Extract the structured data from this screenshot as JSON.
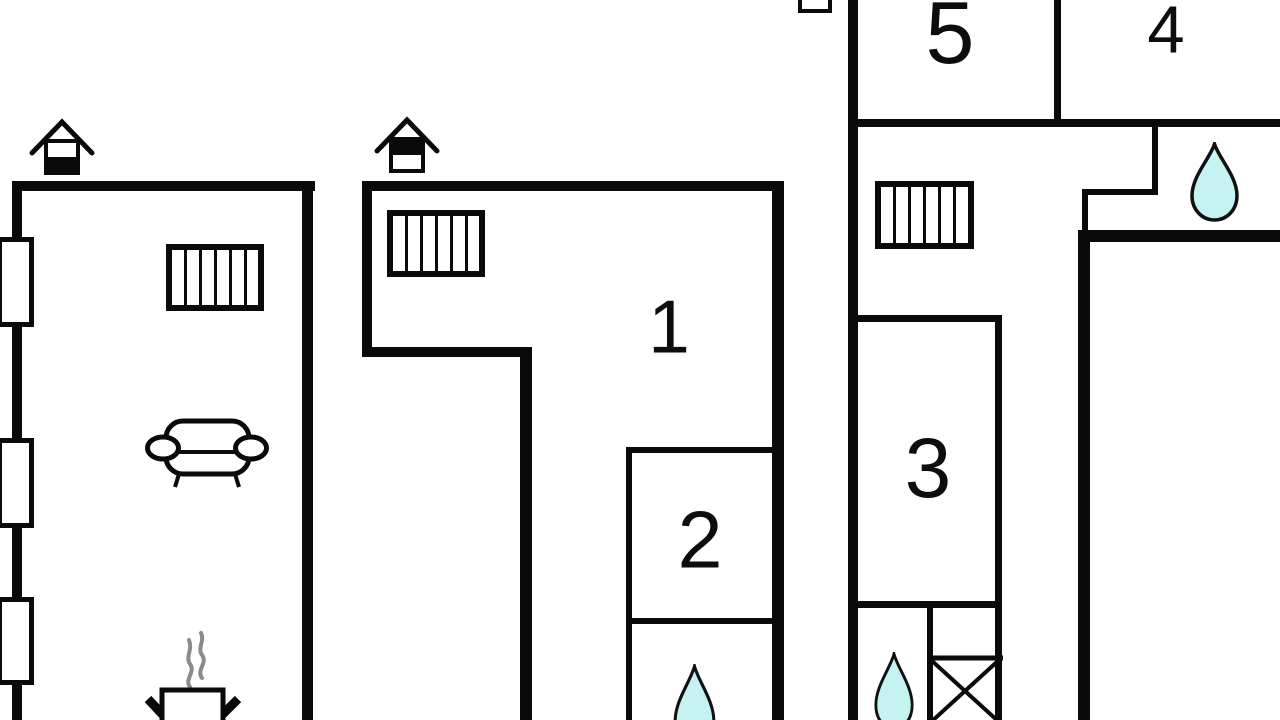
{
  "plan": {
    "type": "floor-plan",
    "background_color": "#ffffff",
    "wall_color": "#0a0a0a",
    "water_color": "#c5f3f1",
    "steam_color": "#8a8a8a",
    "rooms": {
      "r1": {
        "label": "1"
      },
      "r2": {
        "label": "2"
      },
      "r3": {
        "label": "3"
      },
      "r4": {
        "label": "4"
      },
      "r5": {
        "label": "5"
      }
    },
    "symbols": [
      "house-vent-icon-left",
      "house-vent-icon-middle",
      "house-vent-icon-top-cut",
      "radiator-icon-left-building",
      "radiator-icon-middle-building",
      "radiator-icon-right-building",
      "window-icon-1",
      "window-icon-2",
      "window-icon-3",
      "sofa-icon",
      "stove-icon",
      "water-drop-icon-bathroom-top",
      "water-drop-icon-middle-bottom",
      "water-drop-icon-right-bottom",
      "shower-cross-icon"
    ]
  }
}
